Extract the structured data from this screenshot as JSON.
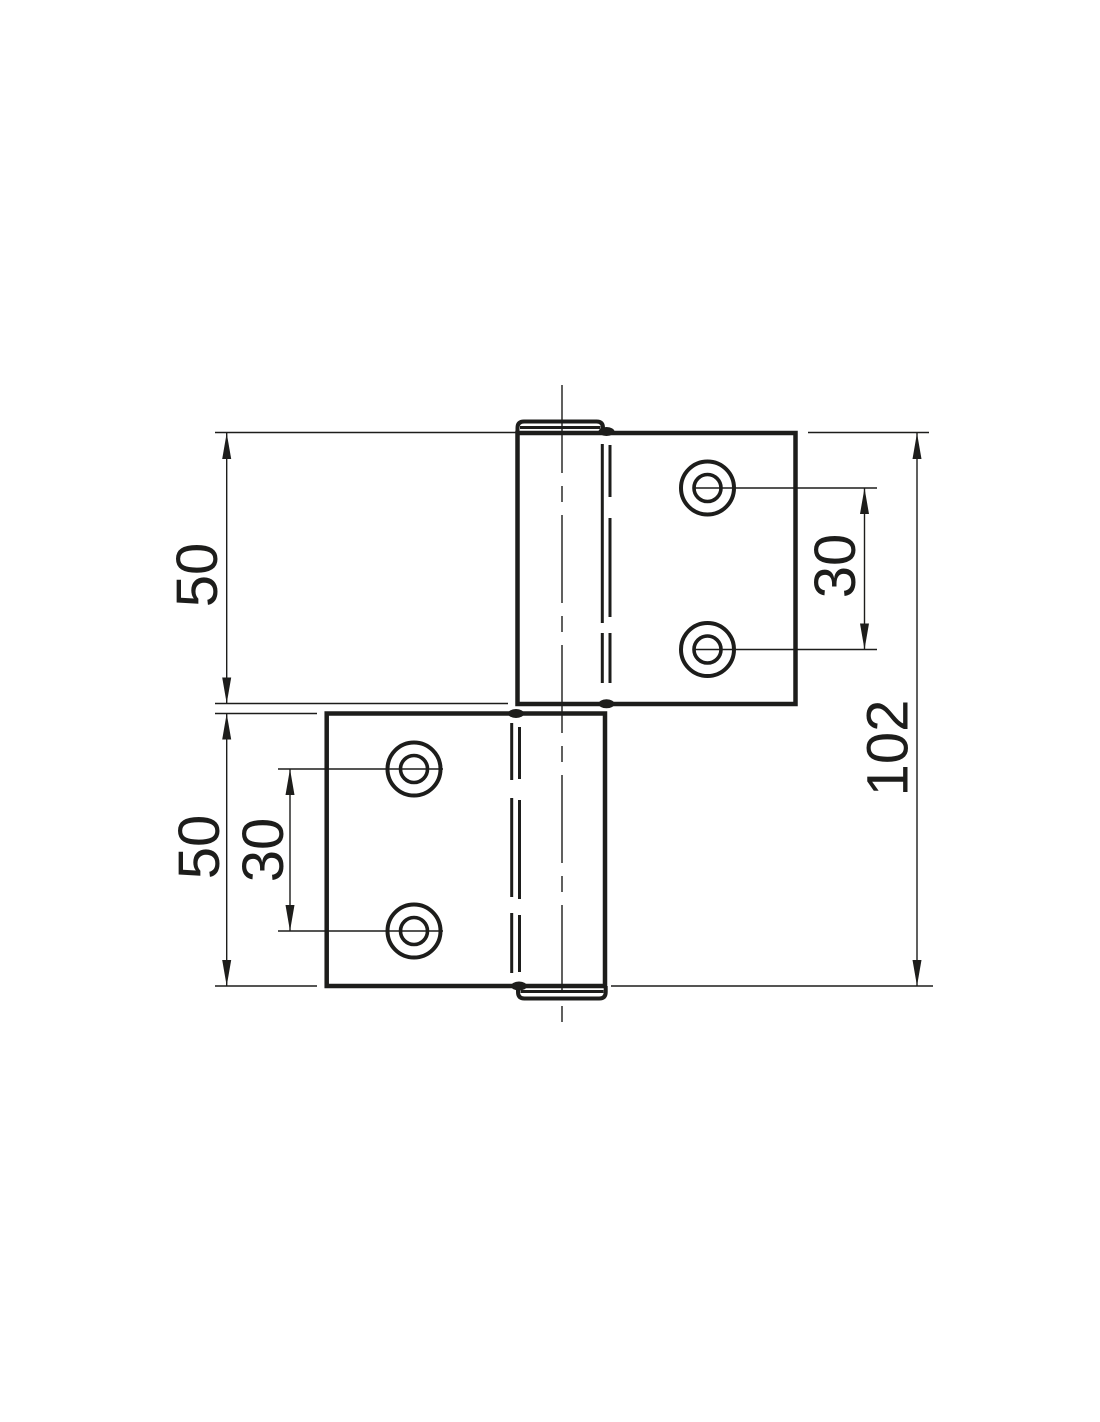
{
  "drawing": {
    "type": "technical-drawing-flag-hinge",
    "background_color": "#ffffff",
    "line_color": "#1d1d1b",
    "labels": {
      "upper_plate_height": "50",
      "lower_plate_height": "50",
      "lower_hole_spacing": "30",
      "upper_hole_spacing": "30",
      "total_height": "102"
    }
  }
}
